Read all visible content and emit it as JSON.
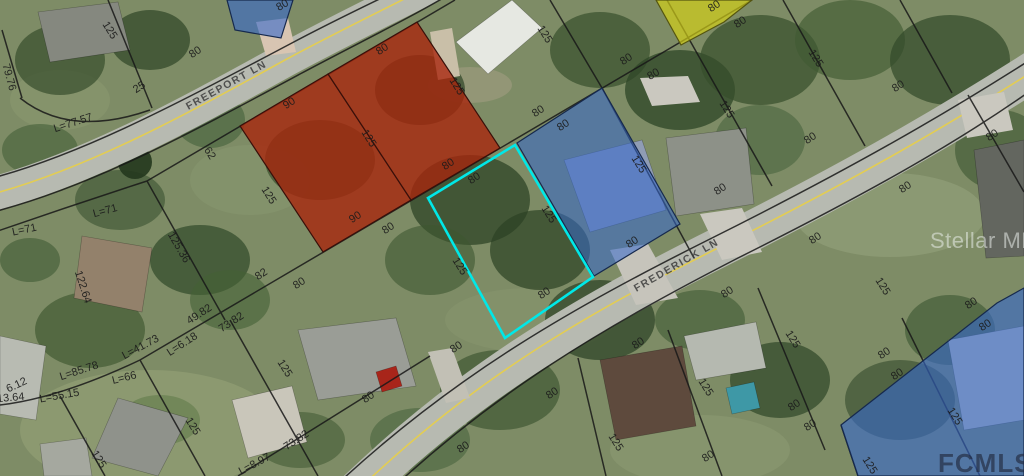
{
  "map": {
    "streets": [
      {
        "name": "FREEPORT LN",
        "x": 228,
        "y": 88,
        "r": -29,
        "size": 10.5
      },
      {
        "name": "FREDERICK LN",
        "x": 678,
        "y": 268,
        "r": -30,
        "size": 10.5
      }
    ],
    "watermarks": [
      {
        "text": "Stellar MLS",
        "x": 930,
        "y": 248,
        "size": 22,
        "color": "#e9ede9",
        "opacity": 0.55,
        "weight": "400",
        "spacing": "0.5"
      },
      {
        "text": "FCMLS",
        "x": 938,
        "y": 472,
        "size": 26,
        "color": "#20263a",
        "opacity": 0.62,
        "weight": "700",
        "spacing": "1"
      }
    ],
    "label_style": {
      "color": "#1b1b1b",
      "size": 11
    },
    "parcels": [
      {
        "name": "overlay-parcel-red-west",
        "points": "240,126 328,74 411,200 323,252",
        "fill": "#a8240c",
        "opacity": 0.78,
        "stroke": "#38100a",
        "sw": 1.2
      },
      {
        "name": "overlay-parcel-red-east",
        "points": "328,74 417,22 500,148 411,200",
        "fill": "#a8240c",
        "opacity": 0.78,
        "stroke": "#38100a",
        "sw": 1.2
      },
      {
        "name": "overlay-parcel-blue-top",
        "points": "227,0 293,0 281,38 235,30",
        "fill": "#3568cc",
        "opacity": 0.6,
        "stroke": "#16294d",
        "sw": 1.2
      },
      {
        "name": "overlay-parcel-blue-middle",
        "points": "517,143 602,88 680,224 594,276",
        "fill": "#3568cc",
        "opacity": 0.55,
        "stroke": "#16294d",
        "sw": 1.2
      },
      {
        "name": "overlay-parcel-blue-bottom-right",
        "points": "841,425 997,303 1024,288 1024,476 858,476",
        "fill": "#3568cc",
        "opacity": 0.6,
        "stroke": "#16294d",
        "sw": 1.2
      },
      {
        "name": "overlay-parcel-yellow",
        "points": "656,0 752,0 724,22 681,45",
        "fill": "#d8d414",
        "opacity": 0.65,
        "stroke": "#55550f",
        "sw": 1.2
      },
      {
        "name": "subject-parcel-outline",
        "points": "515,145 593,277 505,338 428,198",
        "fill": "none",
        "opacity": 1,
        "stroke": "#00e8e8",
        "sw": 2.6
      }
    ],
    "dimension_labels": [
      {
        "t": "125",
        "x": 107,
        "y": 32,
        "r": 58
      },
      {
        "t": "79.76",
        "x": 6,
        "y": 78,
        "r": 75
      },
      {
        "t": "25",
        "x": 141,
        "y": 90,
        "r": -33
      },
      {
        "t": "L=77.57",
        "x": 74,
        "y": 126,
        "r": -18
      },
      {
        "t": "80",
        "x": 197,
        "y": 55,
        "r": -33
      },
      {
        "t": "80",
        "x": 284,
        "y": 8,
        "r": -30
      },
      {
        "t": "62",
        "x": 207,
        "y": 155,
        "r": 58
      },
      {
        "t": "125",
        "x": 266,
        "y": 197,
        "r": 58
      },
      {
        "t": "L=71",
        "x": 25,
        "y": 233,
        "r": -12
      },
      {
        "t": "L=71",
        "x": 106,
        "y": 214,
        "r": -15
      },
      {
        "t": "125.36",
        "x": 176,
        "y": 249,
        "r": 60
      },
      {
        "t": "122.64",
        "x": 80,
        "y": 288,
        "r": 72
      },
      {
        "t": "125",
        "x": 96,
        "y": 461,
        "r": 58
      },
      {
        "t": "125",
        "x": 190,
        "y": 428,
        "r": 58
      },
      {
        "t": "49.82",
        "x": 201,
        "y": 317,
        "r": -33
      },
      {
        "t": "73.82",
        "x": 233,
        "y": 325,
        "r": -33
      },
      {
        "t": "82",
        "x": 263,
        "y": 277,
        "r": -33
      },
      {
        "t": "80",
        "x": 301,
        "y": 286,
        "r": -33
      },
      {
        "t": "L=6.18",
        "x": 184,
        "y": 347,
        "r": -33
      },
      {
        "t": "L=41.73",
        "x": 142,
        "y": 350,
        "r": -28
      },
      {
        "t": "L=85.78",
        "x": 80,
        "y": 374,
        "r": -18
      },
      {
        "t": "L=66",
        "x": 125,
        "y": 381,
        "r": -14
      },
      {
        "t": "6.12",
        "x": 18,
        "y": 388,
        "r": -25
      },
      {
        "t": "13.64",
        "x": 11,
        "y": 401,
        "r": -5
      },
      {
        "t": "L=55.15",
        "x": 60,
        "y": 399,
        "r": -10
      },
      {
        "t": "125",
        "x": 282,
        "y": 370,
        "r": 58
      },
      {
        "t": "73.82",
        "x": 298,
        "y": 443,
        "r": -33
      },
      {
        "t": "L=8.97",
        "x": 256,
        "y": 467,
        "r": -28
      },
      {
        "t": "90",
        "x": 291,
        "y": 106,
        "r": -33
      },
      {
        "t": "80",
        "x": 384,
        "y": 52,
        "r": -33
      },
      {
        "t": "125",
        "x": 366,
        "y": 140,
        "r": 58
      },
      {
        "t": "90",
        "x": 357,
        "y": 220,
        "r": -33
      },
      {
        "t": "80",
        "x": 390,
        "y": 231,
        "r": -33
      },
      {
        "t": "80",
        "x": 450,
        "y": 167,
        "r": -33
      },
      {
        "t": "125",
        "x": 454,
        "y": 88,
        "r": 58
      },
      {
        "t": "80",
        "x": 476,
        "y": 181,
        "r": -33
      },
      {
        "t": "125",
        "x": 546,
        "y": 216,
        "r": 58
      },
      {
        "t": "125",
        "x": 457,
        "y": 268,
        "r": 58
      },
      {
        "t": "80",
        "x": 546,
        "y": 296,
        "r": -33
      },
      {
        "t": "125",
        "x": 542,
        "y": 36,
        "r": 58
      },
      {
        "t": "80",
        "x": 540,
        "y": 114,
        "r": -33
      },
      {
        "t": "80",
        "x": 565,
        "y": 128,
        "r": -33
      },
      {
        "t": "80",
        "x": 628,
        "y": 62,
        "r": -33
      },
      {
        "t": "80",
        "x": 655,
        "y": 77,
        "r": -30
      },
      {
        "t": "80",
        "x": 716,
        "y": 9,
        "r": -33
      },
      {
        "t": "80",
        "x": 742,
        "y": 25,
        "r": -33
      },
      {
        "t": "125",
        "x": 813,
        "y": 60,
        "r": 58
      },
      {
        "t": "125",
        "x": 724,
        "y": 111,
        "r": 58
      },
      {
        "t": "125",
        "x": 636,
        "y": 166,
        "r": 58
      },
      {
        "t": "80",
        "x": 722,
        "y": 192,
        "r": -33
      },
      {
        "t": "80",
        "x": 812,
        "y": 141,
        "r": -33
      },
      {
        "t": "80",
        "x": 634,
        "y": 245,
        "r": -33
      },
      {
        "t": "80",
        "x": 817,
        "y": 241,
        "r": -33
      },
      {
        "t": "80",
        "x": 729,
        "y": 295,
        "r": -33
      },
      {
        "t": "80",
        "x": 900,
        "y": 89,
        "r": -33
      },
      {
        "t": "80",
        "x": 994,
        "y": 138,
        "r": -33
      },
      {
        "t": "80",
        "x": 907,
        "y": 190,
        "r": -33
      },
      {
        "t": "125",
        "x": 880,
        "y": 288,
        "r": 58
      },
      {
        "t": "80",
        "x": 973,
        "y": 306,
        "r": -33
      },
      {
        "t": "80",
        "x": 987,
        "y": 328,
        "r": -33
      },
      {
        "t": "125",
        "x": 790,
        "y": 341,
        "r": 58
      },
      {
        "t": "80",
        "x": 886,
        "y": 356,
        "r": -33
      },
      {
        "t": "80",
        "x": 899,
        "y": 377,
        "r": -33
      },
      {
        "t": "80",
        "x": 796,
        "y": 408,
        "r": -33
      },
      {
        "t": "80",
        "x": 812,
        "y": 428,
        "r": -33
      },
      {
        "t": "125",
        "x": 952,
        "y": 418,
        "r": 58
      },
      {
        "t": "125",
        "x": 867,
        "y": 467,
        "r": 58
      },
      {
        "t": "80",
        "x": 640,
        "y": 346,
        "r": -33
      },
      {
        "t": "80",
        "x": 554,
        "y": 396,
        "r": -33
      },
      {
        "t": "125",
        "x": 703,
        "y": 389,
        "r": 58
      },
      {
        "t": "125",
        "x": 613,
        "y": 444,
        "r": 58
      },
      {
        "t": "80",
        "x": 710,
        "y": 459,
        "r": -33
      },
      {
        "t": "80",
        "x": 458,
        "y": 350,
        "r": -33
      },
      {
        "t": "80",
        "x": 370,
        "y": 400,
        "r": -33
      },
      {
        "t": "80",
        "x": 465,
        "y": 450,
        "r": -33
      }
    ]
  }
}
